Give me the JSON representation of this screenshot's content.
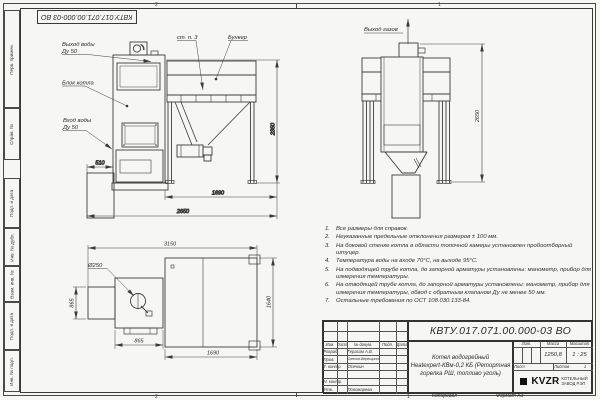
{
  "frame": {
    "doc_number_stamp": "КВТУ.017.071.00.000-03 ВО",
    "zone_top_left": "2",
    "zone_top_right": "1",
    "zone_bottom_left": "2",
    "zone_bottom_right": "1",
    "copied_label": "Копировал",
    "format_label": "Формат А3",
    "margin_stamps": {
      "perv_primen": "Перв. примен.",
      "sprav_no": "Справ. №",
      "podp_data_1": "Подп. и дата",
      "inv_dubl": "Инв. № дубл.",
      "vzam_inv": "Взам. инв. №",
      "podp_data_2": "Подп. и дата",
      "inv_podl": "Инв. № подл."
    }
  },
  "views": {
    "front": {
      "water_out_line1": "Выход воды",
      "water_out_line2": "Ду 50",
      "boiler_block": "Блок котла",
      "water_in_line1": "Вход воды",
      "water_in_line2": "Ду 50",
      "wall_ref": "ст. п. 3",
      "bunker": "Бункер",
      "dim_510": "510",
      "dim_1690": "1690",
      "dim_2650": "2650",
      "dim_2350": "2350"
    },
    "side": {
      "gas_out": "Выход газов",
      "dim_2650": "2650"
    },
    "top": {
      "dia_250": "Ø250",
      "dim_3150": "3150",
      "dim_865_v": "865",
      "dim_865_h": "865",
      "dim_1690": "1690",
      "dim_1640": "1640"
    }
  },
  "notes": [
    {
      "num": "1.",
      "text": "Все размеры для справок."
    },
    {
      "num": "2.",
      "text": "Неуказанные предельные отклонения размеров ± 100 мм."
    },
    {
      "num": "3.",
      "text": "На боковой стенке котла в области топочной камеры установлен пробоотборный штуцер."
    },
    {
      "num": "4.",
      "text": "Температура воды на входе 70°С, на выходе 95°С."
    },
    {
      "num": "5.",
      "text": "На подводящей трубе котла, до запорной арматуры установлены: манометр, прибор для измерения температуры."
    },
    {
      "num": "6.",
      "text": "На отводящей трубе котла, до запорной арматуры установлены: манометр, прибор для измерения температуры, обвод с обратным клапаном Ду не менее 50 мм."
    },
    {
      "num": "7.",
      "text": "Остальные требования по ОСТ 108.030.133-84."
    }
  ],
  "title_block": {
    "doc_number": "КВТУ.017.071.00.000-03 ВО",
    "product_name_line1": "Котел водогрейный",
    "product_name_line2": "Heatexpert-КВм-0,2 КБ (Ретортная",
    "product_name_line3": "горелка РШ, топливо уголь)",
    "sign_cols": [
      "Изм.",
      "Лист",
      "№ докум.",
      "Подп.",
      "Дата"
    ],
    "sign_rows": [
      {
        "label": "Разраб.",
        "name": "Герасим А.В."
      },
      {
        "label": "Пров.",
        "name": "Олесов-Верещинский"
      },
      {
        "label": "Т. контр.",
        "name": "Осечкин"
      },
      {
        "label": "",
        "name": ""
      },
      {
        "label": "Н. контр.",
        "name": ""
      },
      {
        "label": "Утв.",
        "name": "Пономарева"
      }
    ],
    "lit_label": "Лит.",
    "mass_label": "Масса",
    "scale_label": "Масштаб",
    "mass_value": "1250,8",
    "scale_value": "1 : 25",
    "sheet_label": "Лист",
    "sheets_label": "Листов",
    "sheets_value": "1",
    "logo_text": "KVZR",
    "org_line1": "КОТЕЛЬНЫЙ",
    "org_line2": "ЗАВОД РЭП"
  }
}
